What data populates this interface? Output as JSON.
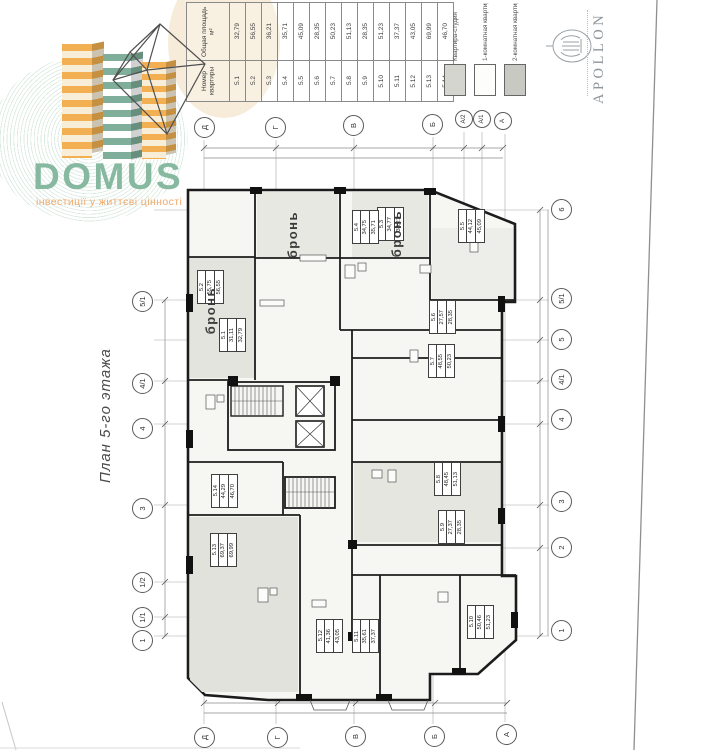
{
  "domus": {
    "name": "DOMUS",
    "tagline": "інвестиції у життєві цінності"
  },
  "apollon": {
    "name": "APOLLON"
  },
  "plan_title": "План 5-го этажа",
  "area_table": {
    "header_area": "Общая площадь м²",
    "header_number": "Номер квартиры",
    "rows": [
      {
        "number": "5.1",
        "area": "32,79"
      },
      {
        "number": "5.2",
        "area": "56,55"
      },
      {
        "number": "5.3",
        "area": "36,21"
      },
      {
        "number": "5.4",
        "area": "35,71"
      },
      {
        "number": "5.5",
        "area": "45,09"
      },
      {
        "number": "5.6",
        "area": "28,35"
      },
      {
        "number": "5.7",
        "area": "50,23"
      },
      {
        "number": "5.8",
        "area": "51,13"
      },
      {
        "number": "5.9",
        "area": "28,35"
      },
      {
        "number": "5.10",
        "area": "51,23"
      },
      {
        "number": "5.11",
        "area": "37,37"
      },
      {
        "number": "5.12",
        "area": "43,05"
      },
      {
        "number": "5.13",
        "area": "69,99"
      },
      {
        "number": "5.14",
        "area": "46,70"
      }
    ]
  },
  "legend": {
    "items": [
      {
        "label": "Квартира-студия",
        "swatch": "#d5d5d0"
      },
      {
        "label": "1-комнатная квартира",
        "swatch": "#fdfdfc"
      },
      {
        "label": "2-комнатная квартира",
        "swatch": "#c9c9c4"
      }
    ]
  },
  "plan": {
    "reserved": "бронь",
    "axes_top": [
      "Д",
      "Г",
      "В",
      "Б",
      "А/2",
      "А/1",
      "А"
    ],
    "axes_bottom": [
      "Д",
      "Г",
      "В",
      "Б",
      "А"
    ],
    "axes_left": [
      "5/1",
      "4/1",
      "4",
      "3",
      "1/2",
      "1/1",
      "1"
    ],
    "axes_right": [
      "6",
      "5/1",
      "5",
      "4/1",
      "4",
      "3",
      "2",
      "1"
    ],
    "units": [
      {
        "number": "5.1",
        "living": "31,11",
        "total": "32,79"
      },
      {
        "number": "5.2",
        "living": "55,75",
        "total": "56,55"
      },
      {
        "number": "5.3",
        "living": "34,77",
        "total": "36,21"
      },
      {
        "number": "5.4",
        "living": "34,75",
        "total": "35,71"
      },
      {
        "number": "5.5",
        "living": "44,12",
        "total": "45,09"
      },
      {
        "number": "5.6",
        "living": "27,57",
        "total": "28,35"
      },
      {
        "number": "5.7",
        "living": "48,55",
        "total": "50,23"
      },
      {
        "number": "5.8",
        "living": "48,45",
        "total": "51,13"
      },
      {
        "number": "5.9",
        "living": "27,37",
        "total": "28,35"
      },
      {
        "number": "5.10",
        "living": "50,46",
        "total": "51,23"
      },
      {
        "number": "5.11",
        "living": "35,61",
        "total": "37,37"
      },
      {
        "number": "5.12",
        "living": "41,36",
        "total": "43,05"
      },
      {
        "number": "5.13",
        "living": "69,37",
        "total": "69,99"
      },
      {
        "number": "5.14",
        "living": "44,29",
        "total": "46,70"
      }
    ]
  },
  "colors": {
    "domus_green": "#87b9a0",
    "domus_orange": "#f0a86a",
    "tower_orange": "#f2b052",
    "tower_teal": "#7fae9a",
    "legend_studio": "#d5d5d0",
    "legend_one_room": "#fdfdfc",
    "legend_two_room": "#c9c9c4"
  }
}
